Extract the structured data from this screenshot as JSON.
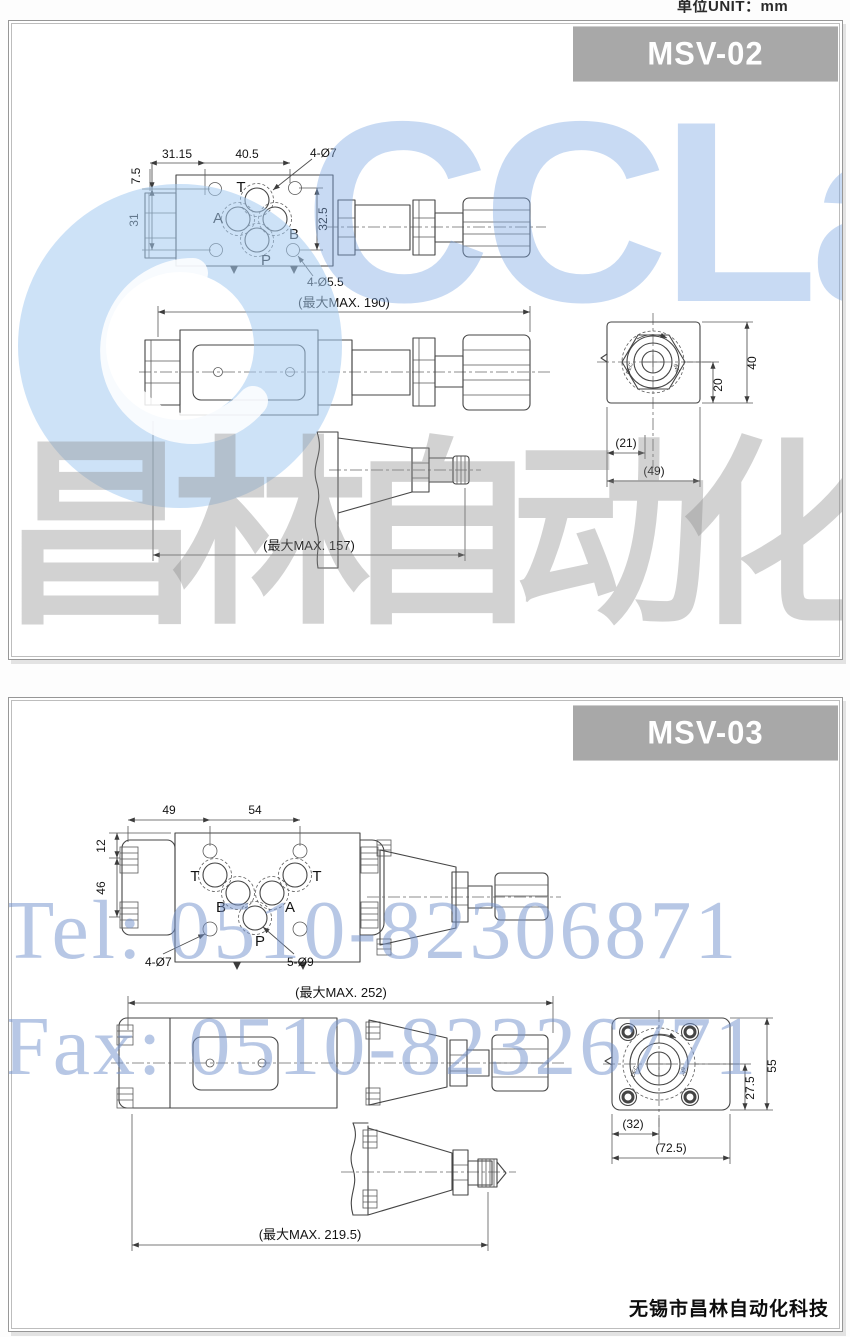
{
  "header": {
    "unit_label": "单位UNIT：mm"
  },
  "watermarks": {
    "brand_text": "CCLair",
    "cn_text": "昌林自动化",
    "tel": "Tel: 0510-82306871",
    "fax": "Fax: 0510-82326771"
  },
  "footer": {
    "company": "无锡市昌林自动化科技"
  },
  "colors": {
    "banner_bg": "#a8a8a8",
    "line": "#454545",
    "watermark_blue": "#9db6e4",
    "watermark_gray": "#c2c2c2"
  },
  "panel1": {
    "banner": "MSV-02",
    "plan": {
      "dim_w1": "31.15",
      "dim_w2": "40.5",
      "label_holes_top": "4-Ø7",
      "label_holes_bottom": "4-Ø5.5",
      "dim_h1": "7.5",
      "dim_h2": "31",
      "dim_h3": "32.5",
      "port_t": "T",
      "port_a": "A",
      "port_b": "B",
      "port_p": "P"
    },
    "side": {
      "dim_total": "(最大MAX. 190)"
    },
    "end": {
      "dim_21": "(21)",
      "dim_49": "(49)",
      "dim_20": "20",
      "dim_40": "40",
      "label_dec": "DEC",
      "label_inc": "INC"
    },
    "detail": {
      "dim_total": "(最大MAX. 157)"
    }
  },
  "panel2": {
    "banner": "MSV-03",
    "plan": {
      "dim_w1": "49",
      "dim_w2": "54",
      "dim_h1": "12",
      "dim_h2": "46",
      "label_holes_small": "4-Ø7",
      "label_holes_big": "5-Ø9",
      "port_t1": "T",
      "port_b": "B",
      "port_a": "A",
      "port_t2": "T",
      "port_p": "P"
    },
    "side": {
      "dim_total": "(最大MAX. 252)"
    },
    "end": {
      "dim_275": "27.5",
      "dim_55": "55",
      "dim_32": "(32)",
      "dim_725": "(72.5)",
      "label_dec": "DEC",
      "label_inc": "INC"
    },
    "detail": {
      "dim_total": "(最大MAX. 219.5)"
    }
  }
}
